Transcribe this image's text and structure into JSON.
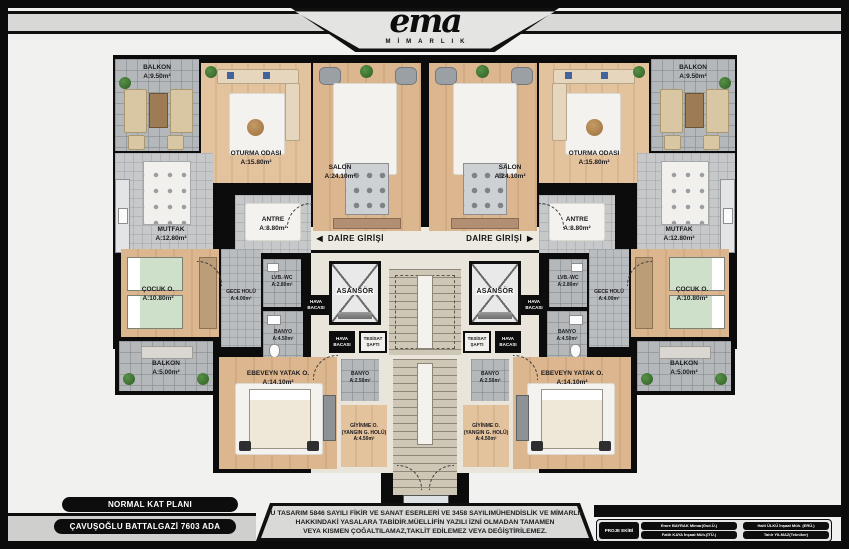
{
  "brand": {
    "logo_text": "ema",
    "logo_subtitle": "MİMARLIK"
  },
  "plan": {
    "entry_label": "DAİRE GİRİŞİ",
    "entry_arrow_left": "◄",
    "entry_arrow_right": "►",
    "rooms": {
      "balkon_ust": {
        "name": "BALKON",
        "area": "A:9.50m²"
      },
      "oturma": {
        "name": "OTURMA ODASI",
        "area": "A:15.80m²"
      },
      "salon": {
        "name": "SALON",
        "area": "A:24.10m²"
      },
      "mutfak": {
        "name": "MUTFAK",
        "area": "A:12.80m²"
      },
      "antre": {
        "name": "ANTRE",
        "area": "A:8.80m²"
      },
      "cocuk": {
        "name": "ÇOCUK O.",
        "area": "A:10.80m²"
      },
      "gece_holu": {
        "name": "GECE HOLÜ",
        "area": "A:4.00m²"
      },
      "lvb_wc": {
        "name": "LVB.-WC",
        "area": "A:2.80m²"
      },
      "banyo_buyuk": {
        "name": "BANYO",
        "area": "A:4.50m²"
      },
      "balkon_alt": {
        "name": "BALKON",
        "area": "A:5.00m²"
      },
      "ebeveyn": {
        "name": "EBEVEYN YATAK O.",
        "area": "A:14.10m²"
      },
      "banyo_kucuk": {
        "name": "BANYO",
        "area": "A:2.50m²"
      },
      "giyinme": {
        "name": "GİYİNME O.",
        "sub": "(YANGIN G. HOLÜ)",
        "area": "A:4.50m²"
      },
      "asansor": {
        "name": "ASANSÖR"
      },
      "hava_bacasi": {
        "line1": "HAVA",
        "line2": "BACASI"
      },
      "tesisat_safti": {
        "line1": "TESİSAT",
        "line2": "ŞAFTI"
      }
    }
  },
  "footer": {
    "plan_label": "NORMAL KAT PLANI",
    "block_label": "ÇAVUŞOĞLU BATTALGAZİ 7603 ADA",
    "copyright": {
      "line1": "BU TASARIM 5846 SAYILI FİKİR VE SANAT ESERLERİ VE 3458 SAYILIMÜHENDİSLİK VE MİMARLIK",
      "line2": "HAKKINDAKİ YASALARA TABİDİR.MÜELLİFİN YAZILI İZNİ OLMADAN TAMAMEN",
      "line3": "VEYA KISMEN ÇOĞALTILAMAZ,TAKLİT EDİLEMEZ VEYA DEĞİŞTİRİLEMEZ."
    },
    "team": {
      "title": "PROJE EKİBİ",
      "members": [
        "Emre BAYRAK Mimar(Gsd.Ü.)",
        "Fatih KAYA İnşaat Müh.(İTÜ.)",
        "Halil ÜLKÜ İnşaat Müh. (ERÜ.)",
        "Tahir YILMAZ(Tekniker)"
      ]
    }
  },
  "colors": {
    "wall": "#0c0c0c",
    "wood_floor": "#d9b48c",
    "tile_floor": "#b4b8bb",
    "hall_floor": "#e9e5db",
    "stair_floor": "#cfc7b6",
    "accent_plant": "#3f7a33"
  }
}
